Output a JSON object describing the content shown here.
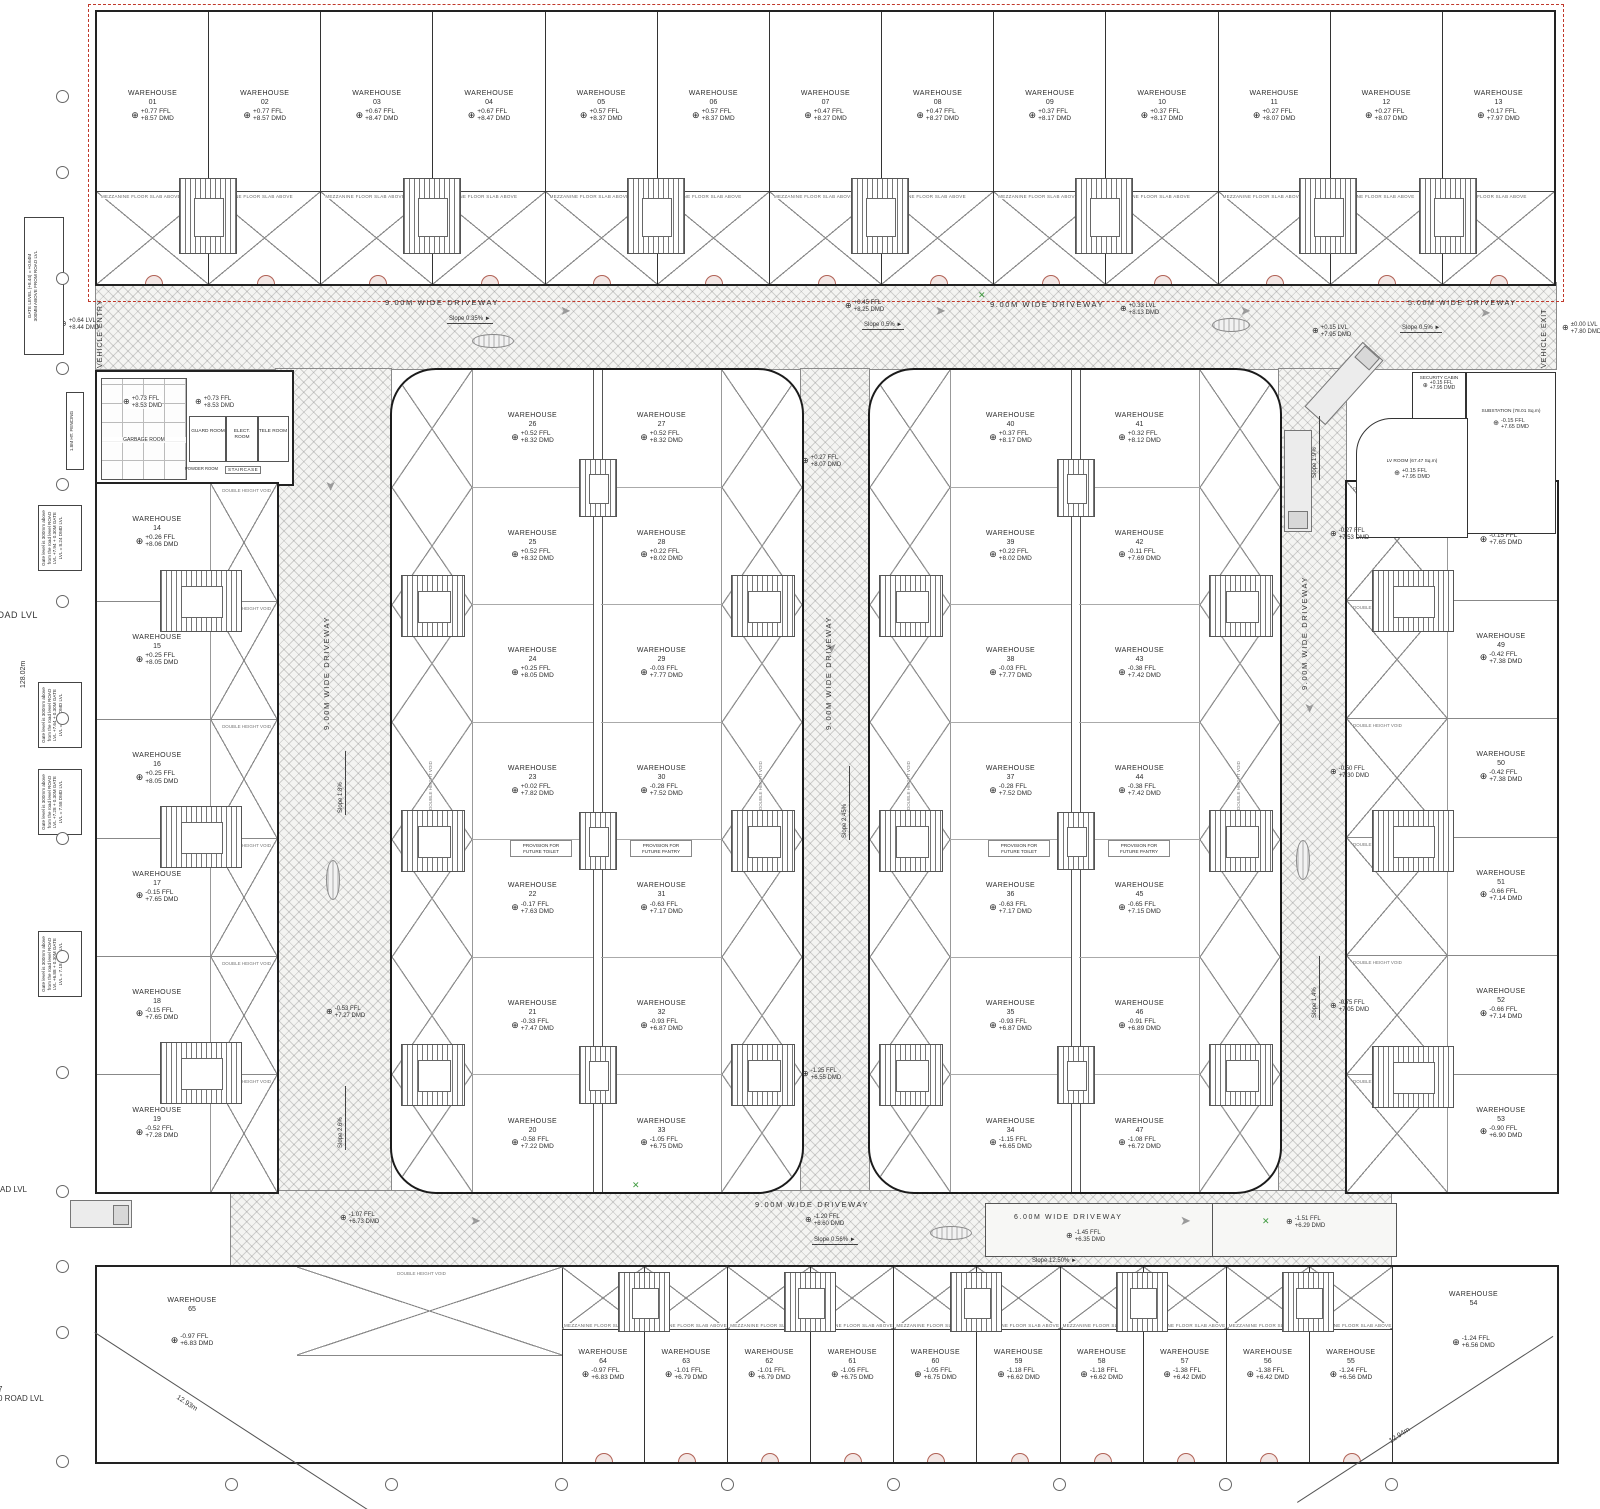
{
  "icons": {
    "level_target": "⊕",
    "flow_arrow": "➤",
    "slope_arrow": "►",
    "green_mark": "✕"
  },
  "labels": {
    "warehouse": "WAREHOUSE",
    "setback": "1M WIDE SETBACK",
    "vehicle_entry": "VEHICLE ENTRY",
    "vehicle_exit": "VEHICLE EXIT",
    "double_height_void": "DOUBLE HEIGHT VOID",
    "mezz": "MEZZANINE FLOOR SLAB ABOVE",
    "staircase": "STAIRCASE",
    "toilet": "PROVISION FOR FUTURE TOILET",
    "pantry": "PROVISION FOR FUTURE PANTRY"
  },
  "notes": {
    "gate_top_1": "GATE LEVEL (+8.44) = +0.64M",
    "gate_top_2": "300MM ABOVE FROM ROAD LVL",
    "gate_notes": [
      "Gate level is 300mm above from the road level ROAD LVL +7.94 + 0.30M GATE LVL = 8.24 DMD LVL",
      "Gate level is 300mm above from the road level ROAD LVL +7.64 + 0.30M GATE LVL = 7.94 DMD LVL",
      "Gate level is 300mm above from the road level ROAD LVL +7.28 + 0.30M GATE LVL = 7.58 DMD LVL",
      "Gate level is 300mm above from the road level ROAD LVL +6.88 + 0.30M GATE LVL = 7.18 DMD LVL"
    ],
    "fencing": "1.8M HT. FENCING",
    "dim_left": "128.02m",
    "dim_bl": "12.93m",
    "dim_br": "12.94m",
    "road_lvl": "ROAD LVL",
    "road_lvl_frag": "7\n0 ROAD LVL"
  },
  "rooms": {
    "garbage": {
      "name": "GARBAGE ROOM",
      "ffl": "+0.73 FFL",
      "dmd": "+8.53 DMD"
    },
    "guard": {
      "name": "GUARD ROOM",
      "ffl": "+0.73 FFL",
      "dmd": "+8.53 DMD"
    },
    "elect": {
      "name": "ELECT. ROOM"
    },
    "tele": {
      "name": "TELE ROOM"
    },
    "powder": {
      "name": "POWDER ROOM"
    },
    "staircase": {
      "name": "STAIRCASE"
    },
    "security": {
      "name": "SECURITY CABIN",
      "ffl": "+0.15 FFL",
      "dmd": "+7.95 DMD"
    },
    "substation": {
      "name": "SUBSTATION (78.01 Sq.m)",
      "ffl": "-0.15 FFL",
      "dmd": "+7.65 DMD"
    },
    "lv": {
      "name": "LV ROOM (67.47 Sq.m)",
      "ffl": "+0.15 FFL",
      "dmd": "+7.95 DMD"
    }
  },
  "driveways": {
    "top_w": "9.00M WIDE DRIVEWAY",
    "exit_w": "5.00M WIDE DRIVEWAY",
    "side_w": "9.00M WIDE DRIVEWAY",
    "bottom_w": "9.00M WIDE DRIVEWAY",
    "ramp_w": "6.00M WIDE DRIVEWAY",
    "slopes": {
      "s035": "Slope 0.35%",
      "s05": "Slope 0.5%",
      "s18": "Slope 1.8%",
      "s19": "Slope 1.9%",
      "s14": "Slope 1.4%",
      "s26": "Slope 2.6%",
      "s245": "Slope 2.45%",
      "s056": "Slope 0.56%",
      "s1250": "Slope 12.50%"
    },
    "levels": {
      "entry": {
        "a": "+0.64 LVL",
        "b": "+8.44 DMD"
      },
      "top_mid": {
        "a": "+0.45 FFL",
        "b": "+8.25 DMD"
      },
      "top_right": {
        "a": "+0.33 LVL",
        "b": "+8.13 DMD"
      },
      "exit1": {
        "a": "+0.15 LVL",
        "b": "+7.95 DMD"
      },
      "exit2": {
        "a": "±0.00 LVL",
        "b": "+7.80 DMD"
      },
      "right1": {
        "a": "-0.27 FFL",
        "b": "+7.53 DMD"
      },
      "right2": {
        "a": "-0.50 FFL",
        "b": "+7.30 DMD"
      },
      "right3": {
        "a": "-0.75 FFL",
        "b": "+7.05 DMD"
      },
      "left1": {
        "a": "-0.53 FFL",
        "b": "+7.27 DMD"
      },
      "center1": {
        "a": "+0.27 FFL",
        "b": "+8.07 DMD"
      },
      "center2": {
        "a": "-1.25 FFL",
        "b": "+6.55 DMD"
      },
      "bottom1": {
        "a": "-1.07 FFL",
        "b": "+6.73 DMD"
      },
      "bottom2": {
        "a": "-1.20 FFL",
        "b": "+6.60 DMD"
      },
      "ramp1": {
        "a": "-1.45 FFL",
        "b": "+6.35 DMD"
      },
      "ramp2": {
        "a": "-1.51 FFL",
        "b": "+6.29 DMD"
      }
    }
  },
  "warehouses": {
    "top_row": [
      {
        "no": "01",
        "ffl": "+0.77 FFL",
        "dmd": "+8.57 DMD"
      },
      {
        "no": "02",
        "ffl": "+0.77 FFL",
        "dmd": "+8.57 DMD"
      },
      {
        "no": "03",
        "ffl": "+0.67 FFL",
        "dmd": "+8.47 DMD"
      },
      {
        "no": "04",
        "ffl": "+0.67 FFL",
        "dmd": "+8.47 DMD"
      },
      {
        "no": "05",
        "ffl": "+0.57 FFL",
        "dmd": "+8.37 DMD"
      },
      {
        "no": "06",
        "ffl": "+0.57 FFL",
        "dmd": "+8.37 DMD"
      },
      {
        "no": "07",
        "ffl": "+0.47 FFL",
        "dmd": "+8.27 DMD"
      },
      {
        "no": "08",
        "ffl": "+0.47 FFL",
        "dmd": "+8.27 DMD"
      },
      {
        "no": "09",
        "ffl": "+0.37 FFL",
        "dmd": "+8.17 DMD"
      },
      {
        "no": "10",
        "ffl": "+0.37 FFL",
        "dmd": "+8.17 DMD"
      },
      {
        "no": "11",
        "ffl": "+0.27 FFL",
        "dmd": "+8.07 DMD"
      },
      {
        "no": "12",
        "ffl": "+0.27 FFL",
        "dmd": "+8.07 DMD"
      },
      {
        "no": "13",
        "ffl": "+0.17 FFL",
        "dmd": "+7.97 DMD"
      }
    ],
    "left_col": [
      {
        "no": "14",
        "ffl": "+0.26 FFL",
        "dmd": "+8.06 DMD"
      },
      {
        "no": "15",
        "ffl": "+0.25 FFL",
        "dmd": "+8.05 DMD"
      },
      {
        "no": "16",
        "ffl": "+0.25 FFL",
        "dmd": "+8.05 DMD"
      },
      {
        "no": "17",
        "ffl": "-0.15 FFL",
        "dmd": "+7.65 DMD"
      },
      {
        "no": "18",
        "ffl": "-0.15 FFL",
        "dmd": "+7.65 DMD"
      },
      {
        "no": "19",
        "ffl": "-0.52 FFL",
        "dmd": "+7.28 DMD"
      }
    ],
    "a_left": [
      {
        "no": "26",
        "ffl": "+0.52 FFL",
        "dmd": "+8.32 DMD"
      },
      {
        "no": "25",
        "ffl": "+0.52 FFL",
        "dmd": "+8.32 DMD"
      },
      {
        "no": "24",
        "ffl": "+0.25 FFL",
        "dmd": "+8.05 DMD"
      },
      {
        "no": "23",
        "ffl": "+0.02 FFL",
        "dmd": "+7.82 DMD"
      },
      {
        "no": "22",
        "ffl": "-0.17 FFL",
        "dmd": "+7.63 DMD"
      },
      {
        "no": "21",
        "ffl": "-0.33 FFL",
        "dmd": "+7.47 DMD"
      },
      {
        "no": "20",
        "ffl": "-0.58 FFL",
        "dmd": "+7.22 DMD"
      }
    ],
    "a_right": [
      {
        "no": "27",
        "ffl": "+0.52 FFL",
        "dmd": "+8.32 DMD"
      },
      {
        "no": "28",
        "ffl": "+0.22 FFL",
        "dmd": "+8.02 DMD"
      },
      {
        "no": "29",
        "ffl": "-0.03 FFL",
        "dmd": "+7.77 DMD"
      },
      {
        "no": "30",
        "ffl": "-0.28 FFL",
        "dmd": "+7.52 DMD"
      },
      {
        "no": "31",
        "ffl": "-0.63 FFL",
        "dmd": "+7.17 DMD"
      },
      {
        "no": "32",
        "ffl": "-0.93 FFL",
        "dmd": "+6.87 DMD"
      },
      {
        "no": "33",
        "ffl": "-1.05 FFL",
        "dmd": "+6.75 DMD"
      }
    ],
    "b_left": [
      {
        "no": "40",
        "ffl": "+0.37 FFL",
        "dmd": "+8.17 DMD"
      },
      {
        "no": "39",
        "ffl": "+0.22 FFL",
        "dmd": "+8.02 DMD"
      },
      {
        "no": "38",
        "ffl": "-0.03 FFL",
        "dmd": "+7.77 DMD"
      },
      {
        "no": "37",
        "ffl": "-0.28 FFL",
        "dmd": "+7.52 DMD"
      },
      {
        "no": "36",
        "ffl": "-0.63 FFL",
        "dmd": "+7.17 DMD"
      },
      {
        "no": "35",
        "ffl": "-0.93 FFL",
        "dmd": "+6.87 DMD"
      },
      {
        "no": "34",
        "ffl": "-1.15 FFL",
        "dmd": "+6.65 DMD"
      }
    ],
    "b_right": [
      {
        "no": "41",
        "ffl": "+0.32 FFL",
        "dmd": "+8.12 DMD"
      },
      {
        "no": "42",
        "ffl": "-0.11 FFL",
        "dmd": "+7.69 DMD"
      },
      {
        "no": "43",
        "ffl": "-0.38 FFL",
        "dmd": "+7.42 DMD"
      },
      {
        "no": "44",
        "ffl": "-0.38 FFL",
        "dmd": "+7.42 DMD"
      },
      {
        "no": "45",
        "ffl": "-0.65 FFL",
        "dmd": "+7.15 DMD"
      },
      {
        "no": "46",
        "ffl": "-0.91 FFL",
        "dmd": "+6.89 DMD"
      },
      {
        "no": "47",
        "ffl": "-1.08 FFL",
        "dmd": "+6.72 DMD"
      }
    ],
    "right_col": [
      {
        "no": "48",
        "ffl": "-0.15 FFL",
        "dmd": "+7.65 DMD"
      },
      {
        "no": "49",
        "ffl": "-0.42 FFL",
        "dmd": "+7.38 DMD"
      },
      {
        "no": "50",
        "ffl": "-0.42 FFL",
        "dmd": "+7.38 DMD"
      },
      {
        "no": "51",
        "ffl": "-0.66 FFL",
        "dmd": "+7.14 DMD"
      },
      {
        "no": "52",
        "ffl": "-0.66 FFL",
        "dmd": "+7.14 DMD"
      },
      {
        "no": "53",
        "ffl": "-0.90 FFL",
        "dmd": "+6.90 DMD"
      }
    ],
    "bottom_row": [
      {
        "no": "64",
        "ffl": "-0.97 FFL",
        "dmd": "+6.83 DMD"
      },
      {
        "no": "63",
        "ffl": "-1.01 FFL",
        "dmd": "+6.79 DMD"
      },
      {
        "no": "62",
        "ffl": "-1.01 FFL",
        "dmd": "+6.79 DMD"
      },
      {
        "no": "61",
        "ffl": "-1.05 FFL",
        "dmd": "+6.75 DMD"
      },
      {
        "no": "60",
        "ffl": "-1.05 FFL",
        "dmd": "+6.75 DMD"
      },
      {
        "no": "59",
        "ffl": "-1.18 FFL",
        "dmd": "+6.62 DMD"
      },
      {
        "no": "58",
        "ffl": "-1.18 FFL",
        "dmd": "+6.62 DMD"
      },
      {
        "no": "57",
        "ffl": "-1.38 FFL",
        "dmd": "+6.42 DMD"
      },
      {
        "no": "56",
        "ffl": "-1.38 FFL",
        "dmd": "+6.42 DMD"
      },
      {
        "no": "55",
        "ffl": "-1.24 FFL",
        "dmd": "+6.56 DMD"
      }
    ],
    "corner_left": {
      "no": "65",
      "ffl": "-0.97 FFL",
      "dmd": "+6.83 DMD"
    },
    "corner_right": {
      "no": "54",
      "ffl": "-1.24 FFL",
      "dmd": "+6.56 DMD"
    }
  }
}
